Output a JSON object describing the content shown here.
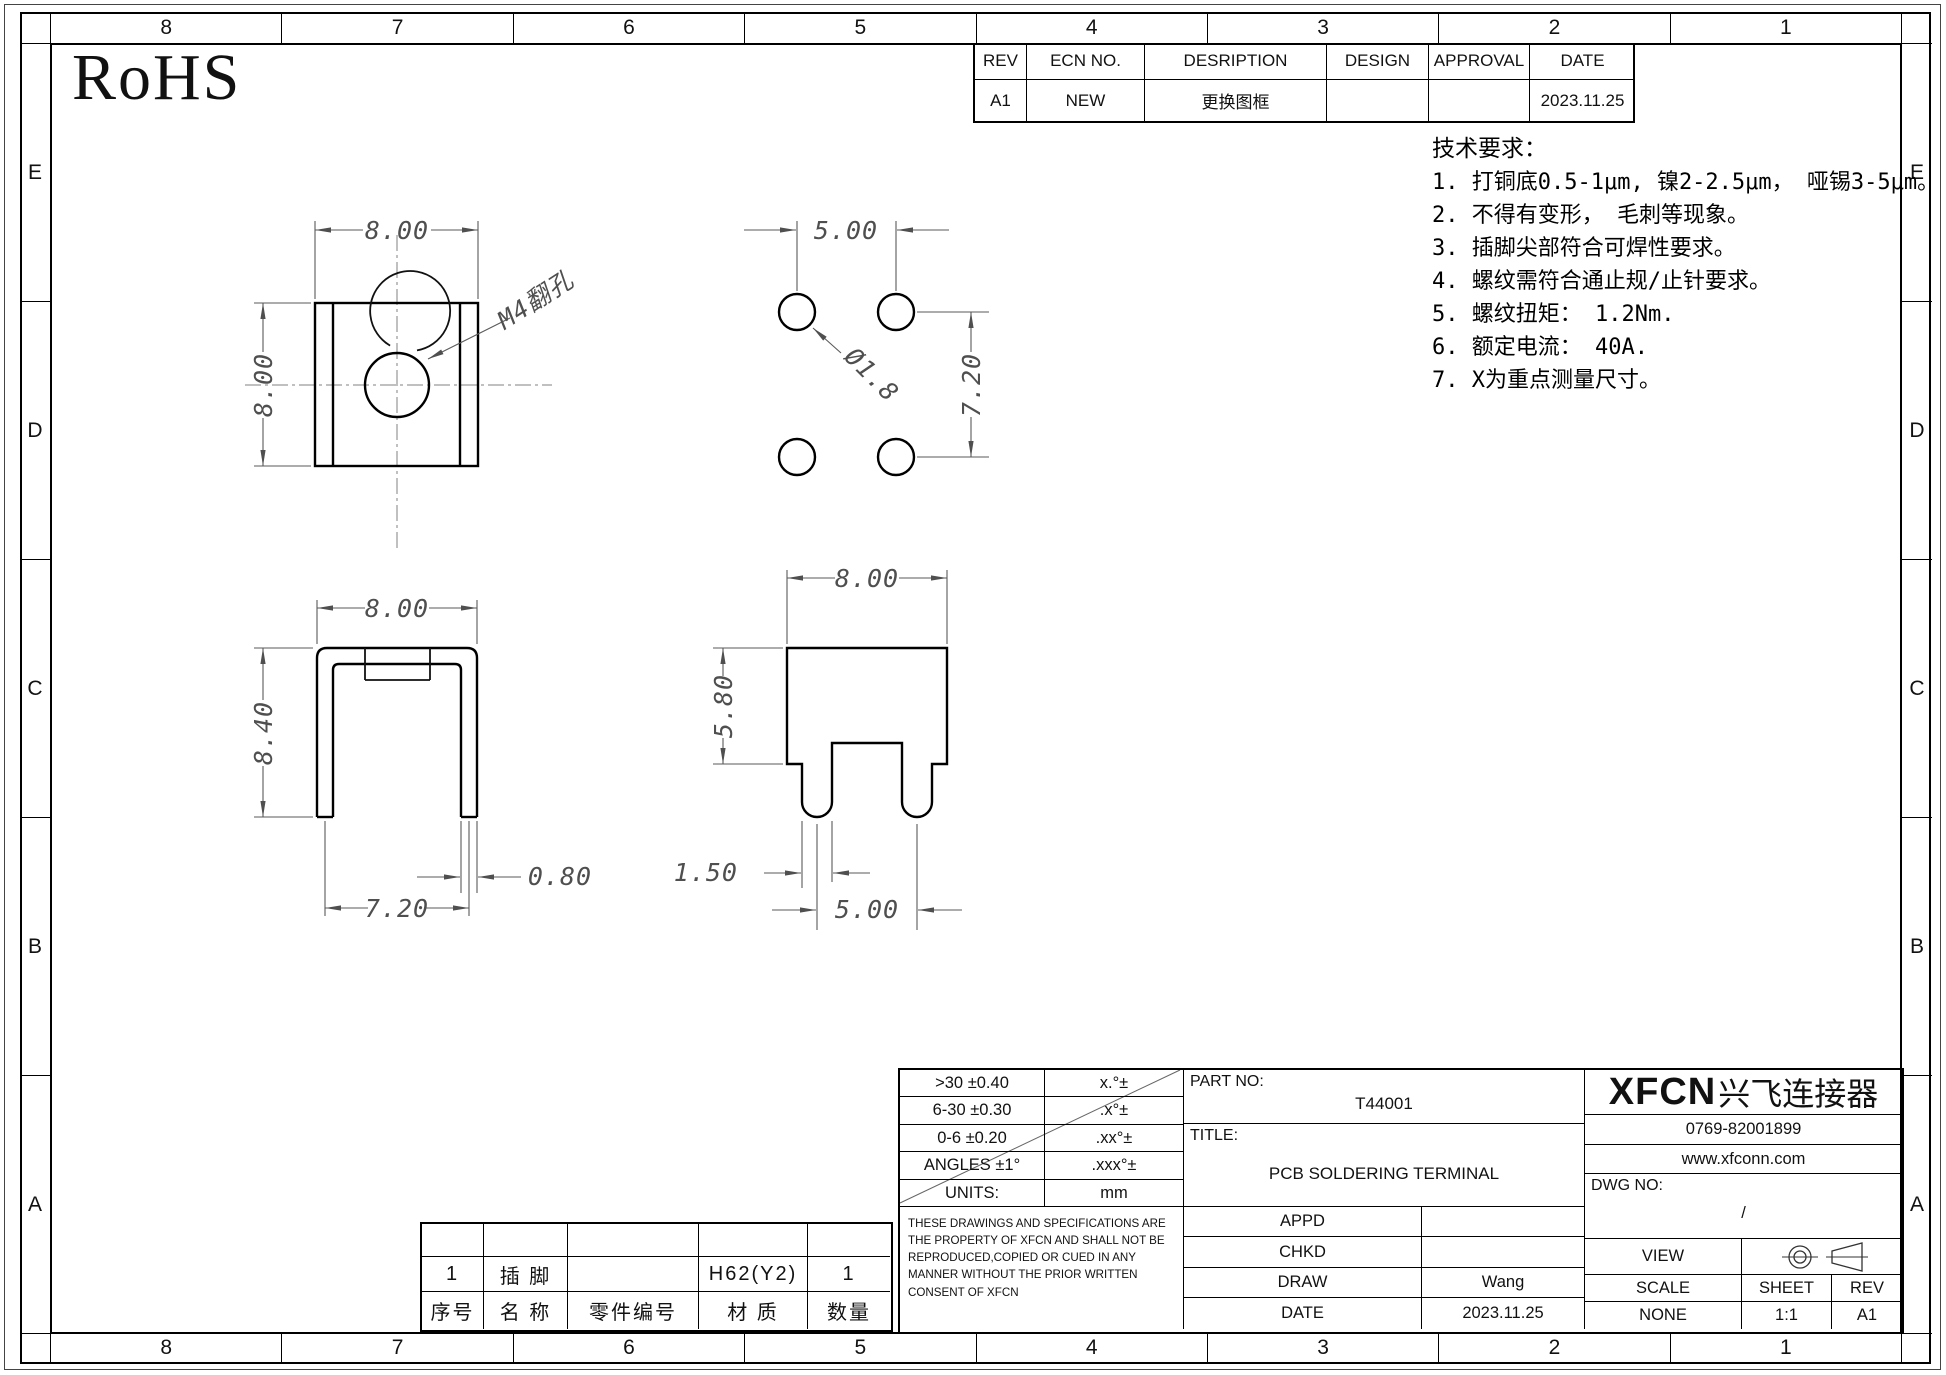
{
  "sheet": {
    "zone_columns": [
      "8",
      "7",
      "6",
      "5",
      "4",
      "3",
      "2",
      "1"
    ],
    "zone_rows": [
      "E",
      "D",
      "C",
      "B",
      "A"
    ],
    "rohs": "RoHS"
  },
  "revision_table": {
    "headers": [
      "REV",
      "ECN NO.",
      "DESRIPTION",
      "DESIGN",
      "APPROVAL",
      "DATE"
    ],
    "rows": [
      [
        "A1",
        "NEW",
        "更换图框",
        "",
        "",
        "2023.11.25"
      ]
    ]
  },
  "tech_requirements": {
    "title": "技术要求：",
    "items": [
      "1. 打铜底0.5-1μm, 镍2-2.5μm， 哑锡3-5μm。",
      "2. 不得有变形， 毛刺等现象。",
      "3. 插脚尖部符合可焊性要求。",
      "4. 螺纹需符合通止规/止针要求。",
      "5. 螺纹扭矩： 1.2Nm.",
      "6. 额定电流： 40A.",
      "7. X为重点测量尺寸。"
    ]
  },
  "views": {
    "nut_top": {
      "dim_width": "8.00",
      "dim_height": "8.00",
      "hole_label": "M4翻孔"
    },
    "hole_pattern": {
      "dim_pitch_x": "5.00",
      "dim_pitch_y": "7.20",
      "dim_dia": "Ø1.8"
    },
    "side": {
      "dim_width": "8.00",
      "dim_height": "8.40",
      "dim_thickness": "0.80",
      "dim_span": "7.20"
    },
    "front": {
      "dim_width": "8.00",
      "dim_height": "5.80",
      "dim_leg_width": "1.50",
      "dim_leg_pitch": "5.00"
    }
  },
  "tolerance_table": {
    "rows": [
      [
        ">30 ±0.40",
        "x.°±"
      ],
      [
        "6-30 ±0.30",
        ".x°±"
      ],
      [
        "0-6 ±0.20",
        ".xx°±"
      ],
      [
        "ANGLES ±1°",
        ".xxx°±"
      ],
      [
        "UNITS:",
        "mm"
      ]
    ]
  },
  "disclaimer": "THESE DRAWINGS AND SPECIFICATIONS ARE THE PROPERTY OF XFCN AND SHALL NOT BE REPRODUCED,COPIED OR CUED IN ANY MANNER WITHOUT THE PRIOR WRITTEN CONSENT OF XFCN",
  "bom_table": {
    "data_row": [
      "1",
      "插 脚",
      "",
      "H62(Y2)",
      "1"
    ],
    "header_row": [
      "序号",
      "名 称",
      "零件编号",
      "材 质",
      "数量"
    ]
  },
  "title_block": {
    "part_no_label": "PART NO:",
    "part_no": "T44001",
    "title_label": "TITLE:",
    "title": "PCB SOLDERING TERMINAL",
    "company_logo": "XFCN",
    "company_name": "兴飞连接器",
    "phone": "0769-82001899",
    "website": "www.xfconn.com",
    "dwg_no_label": "DWG NO:",
    "dwg_no": "/",
    "appd_label": "APPD",
    "appd_value": "",
    "chkd_label": "CHKD",
    "chkd_value": "",
    "draw_label": "DRAW",
    "draw_value": "Wang",
    "date_label": "DATE",
    "date_value": "2023.11.25",
    "view_label": "VIEW",
    "scale_label": "SCALE",
    "scale_value": "NONE",
    "sheet_label": "SHEET",
    "sheet_value": "1:1",
    "rev_label": "REV",
    "rev_value": "A1"
  }
}
